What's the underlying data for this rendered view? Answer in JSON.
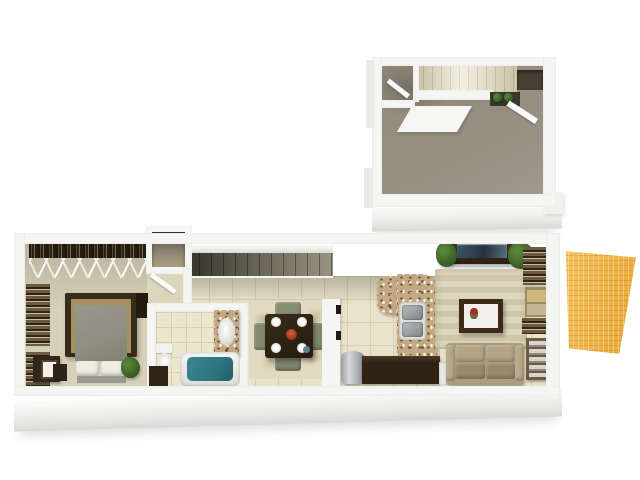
{
  "scene": {
    "alt": "3D rendered floor plan of a two-level apartment with upper loft, bedroom, bathroom, dining area, kitchen, living room and outdoor deck",
    "units": [
      {
        "id": "upper-floor",
        "rooms": [
          "loft-room",
          "stair-landing",
          "staircase-up",
          "loft-closet"
        ]
      },
      {
        "id": "main-floor",
        "rooms": [
          "bedroom",
          "hall-closets",
          "bathroom",
          "stairwell",
          "dining-area",
          "kitchen",
          "living-room"
        ]
      },
      {
        "id": "exterior",
        "rooms": [
          "deck-patio"
        ]
      }
    ],
    "furniture": {
      "bedroom": [
        "hanging-clothes-closet",
        "hanger-rack",
        "slatted-shelves",
        "dresser-with-photo",
        "bed",
        "pillows",
        "nightstand",
        "potted-plant"
      ],
      "bathroom": [
        "vanity-sink",
        "toilet",
        "bathtub",
        "corner-cabinet"
      ],
      "dining_area": [
        "area-rug",
        "dining-table",
        "four-chairs",
        "place-settings",
        "center-bowl"
      ],
      "kitchen": [
        "pantry",
        "trash-can",
        "granite-counter",
        "double-sink",
        "island-counter",
        "dishwasher"
      ],
      "living_room": [
        "tv-console",
        "flat-tv",
        "two-plants",
        "striped-rug",
        "framed-art",
        "sofa",
        "wall-shelves",
        "ladder-chair"
      ],
      "upper_floor": [
        "cream-staircase",
        "carpet",
        "shelf-closet",
        "door-leaves"
      ]
    },
    "colors": {
      "bg": "#ffffff",
      "wall": "#f5f5f3",
      "wallDim": "#e3e3e0",
      "wallFaceLight": "#fbfbfa",
      "wallFaceDark": "#d9d9d6",
      "tile": "#e9e3cb",
      "grout": "#d6cfb3",
      "tileBath": "#ece6cf",
      "bedroomFloor": "#d7d0b8",
      "bedroomFloorDark": "#b9b29a",
      "hallFloor": "#dcd5be",
      "carpet": "#918879",
      "stairCream": "#e9e2c8",
      "stairCreamLine": "#c6bd9e",
      "stairwellDark": "#34322a",
      "stairwellLight": "#989382",
      "woodDark": "#31261a",
      "woodMid": "#6e5a3e",
      "tanAccent": "#a8905e",
      "bedSpread": "#8e8e82",
      "pillow": "#efece2",
      "plant": "#3e6429",
      "plantDark": "#2c4a1e",
      "tubWater": "#2e747e",
      "porcelain": "#f1f2ee",
      "steel": "#b9bdbf",
      "steelDark": "#7e8487",
      "granite": "#c3a983",
      "islandWood": "#2f2316",
      "sofa": "#ab9c80",
      "sofaDark": "#998a6e",
      "rugStripeA": "#ded6bd",
      "rugStripeB": "#cfc7ab",
      "rugDining": "#e2d9c1",
      "frame": "#3f2a16",
      "flower": "#a23120",
      "tv": "#26323f",
      "deck": "#f2b23c",
      "clothesDark": "#241e15",
      "shadowTint": "rgba(60,55,40,0.28)"
    }
  }
}
